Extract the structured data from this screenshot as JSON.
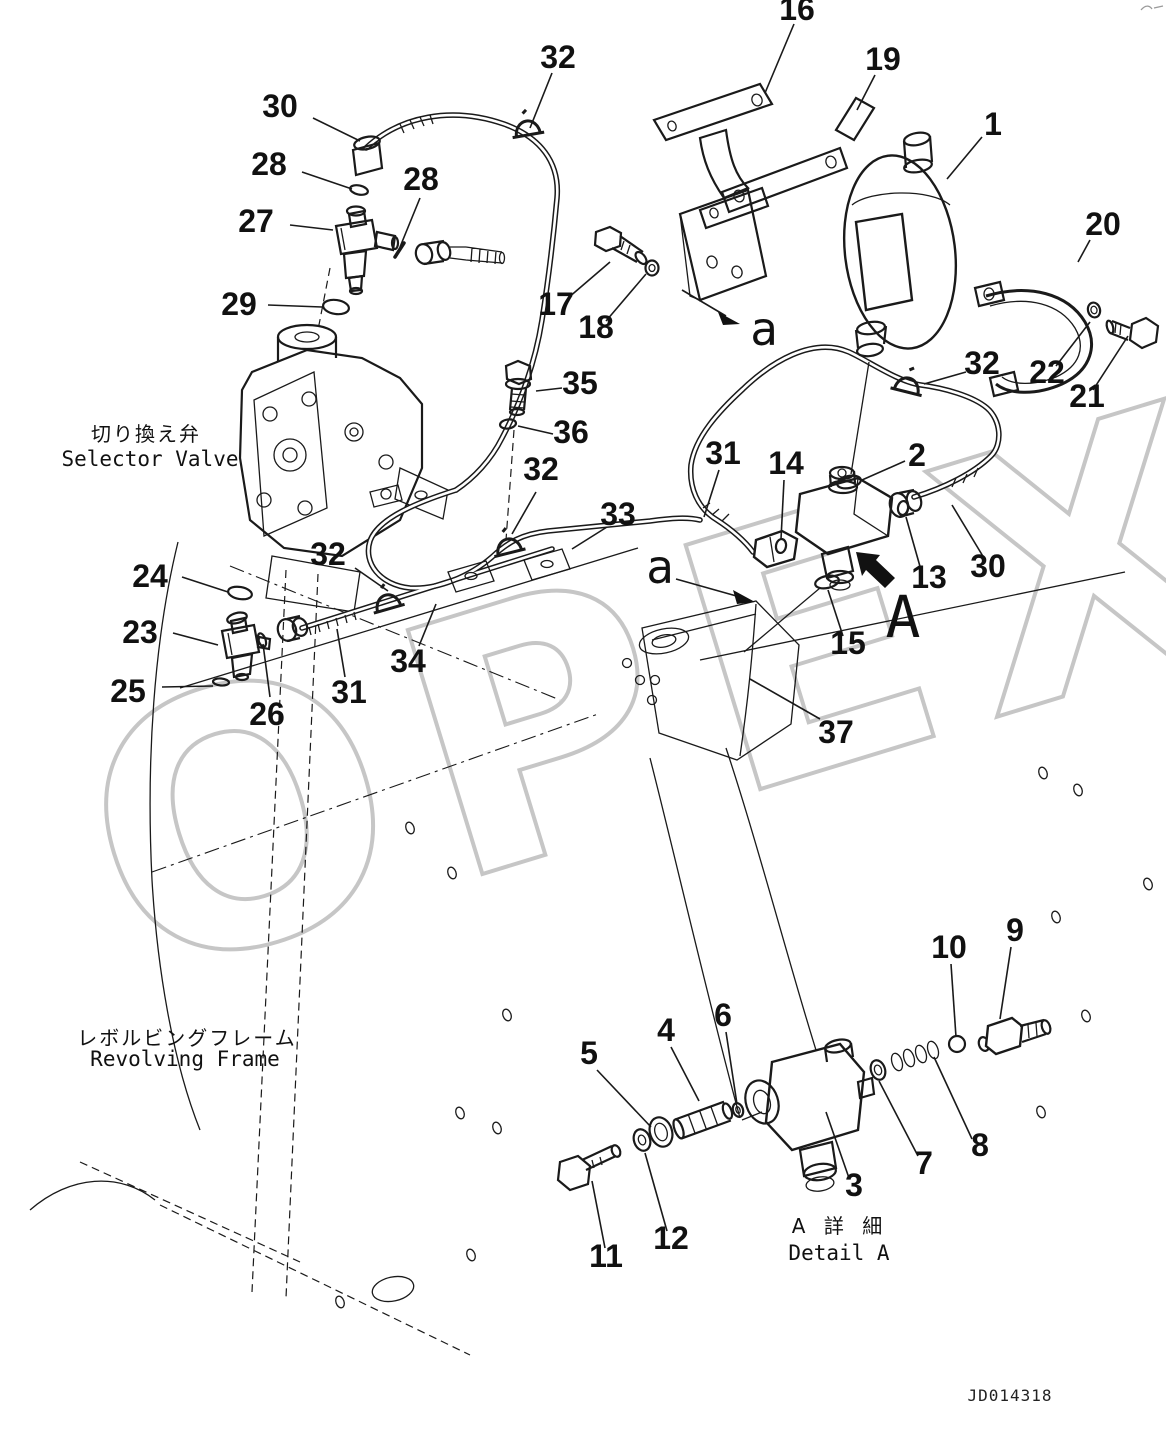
{
  "drawing": {
    "number": "JD014318",
    "watermark": "OPEX"
  },
  "captions": {
    "selector_valve_jp": "切り換え弁",
    "selector_valve_en": "Selector Valve",
    "revolving_frame_jp": "レボルビングフレーム",
    "revolving_frame_en": "Revolving Frame",
    "detail_a_jp": "A 詳 細",
    "detail_a_en": "Detail A"
  },
  "view_labels": {
    "a_top": "a",
    "a_mid": "a",
    "detail": "A"
  },
  "callouts": [
    {
      "label": "1",
      "x": 993,
      "y": 135,
      "leader": [
        982,
        137,
        947,
        179
      ]
    },
    {
      "label": "2",
      "x": 917,
      "y": 466,
      "leader": [
        905,
        461,
        862,
        480
      ]
    },
    {
      "label": "3",
      "x": 854,
      "y": 1196,
      "leader": [
        849,
        1178,
        826,
        1112
      ]
    },
    {
      "label": "4",
      "x": 666,
      "y": 1041,
      "leader": [
        671,
        1047,
        699,
        1101
      ]
    },
    {
      "label": "5",
      "x": 589,
      "y": 1064,
      "leader": [
        597,
        1070,
        651,
        1127
      ]
    },
    {
      "label": "6",
      "x": 723,
      "y": 1026,
      "leader": [
        726,
        1032,
        737,
        1104
      ]
    },
    {
      "label": "7",
      "x": 924,
      "y": 1174,
      "leader": [
        918,
        1156,
        879,
        1081
      ]
    },
    {
      "label": "8",
      "x": 980,
      "y": 1156,
      "leader": [
        972,
        1139,
        934,
        1057
      ]
    },
    {
      "label": "9",
      "x": 1015,
      "y": 941,
      "leader": [
        1011,
        947,
        1000,
        1019
      ]
    },
    {
      "label": "10",
      "x": 949,
      "y": 958,
      "leader": [
        951,
        964,
        956,
        1037
      ]
    },
    {
      "label": "11",
      "x": 606,
      "y": 1267,
      "leader": [
        605,
        1248,
        592,
        1181
      ]
    },
    {
      "label": "12",
      "x": 671,
      "y": 1249,
      "leader": [
        667,
        1231,
        645,
        1153
      ]
    },
    {
      "label": "13",
      "x": 929,
      "y": 588,
      "leader": [
        921,
        570,
        906,
        517
      ]
    },
    {
      "label": "14",
      "x": 786,
      "y": 474,
      "leader": [
        784,
        480,
        781,
        539
      ]
    },
    {
      "label": "15",
      "x": 848,
      "y": 654,
      "leader": [
        843,
        636,
        828,
        590
      ]
    },
    {
      "label": "16",
      "x": 797,
      "y": 20,
      "leader": [
        794,
        24,
        765,
        93
      ]
    },
    {
      "label": "17",
      "x": 556,
      "y": 315,
      "leader": [
        568,
        298,
        610,
        262
      ]
    },
    {
      "label": "18",
      "x": 596,
      "y": 338,
      "leader": [
        606,
        321,
        646,
        274
      ]
    },
    {
      "label": "19",
      "x": 883,
      "y": 70,
      "leader": [
        875,
        75,
        857,
        110
      ]
    },
    {
      "label": "20",
      "x": 1103,
      "y": 235,
      "leader": [
        1090,
        240,
        1078,
        262
      ]
    },
    {
      "label": "21",
      "x": 1087,
      "y": 407,
      "leader": [
        1093,
        390,
        1128,
        336
      ]
    },
    {
      "label": "22",
      "x": 1047,
      "y": 383,
      "leader": [
        1056,
        366,
        1090,
        322
      ]
    },
    {
      "label": "23",
      "x": 140,
      "y": 643,
      "leader": [
        173,
        633,
        218,
        645
      ]
    },
    {
      "label": "24",
      "x": 150,
      "y": 587,
      "leader": [
        182,
        577,
        228,
        592
      ]
    },
    {
      "label": "25",
      "x": 128,
      "y": 702,
      "leader": [
        162,
        687,
        213,
        686
      ]
    },
    {
      "label": "26",
      "x": 267,
      "y": 725,
      "leader": [
        270,
        697,
        263,
        644
      ]
    },
    {
      "label": "27",
      "x": 256,
      "y": 232,
      "leader": [
        290,
        225,
        333,
        230
      ]
    },
    {
      "label": "28",
      "x": 269,
      "y": 175,
      "leader": [
        302,
        172,
        352,
        189
      ]
    },
    {
      "label": "28",
      "x": 421,
      "y": 190,
      "leader": [
        420,
        198,
        400,
        247
      ]
    },
    {
      "label": "29",
      "x": 239,
      "y": 315,
      "leader": [
        268,
        305,
        322,
        307
      ]
    },
    {
      "label": "30",
      "x": 280,
      "y": 117,
      "leader": [
        313,
        118,
        360,
        141
      ]
    },
    {
      "label": "30",
      "x": 988,
      "y": 577,
      "leader": [
        984,
        558,
        952,
        505
      ]
    },
    {
      "label": "31",
      "x": 723,
      "y": 464,
      "leader": [
        719,
        470,
        704,
        517
      ]
    },
    {
      "label": "31",
      "x": 349,
      "y": 703,
      "leader": [
        345,
        677,
        337,
        629
      ]
    },
    {
      "label": "32",
      "x": 558,
      "y": 68,
      "leader": [
        552,
        73,
        530,
        128
      ]
    },
    {
      "label": "32",
      "x": 982,
      "y": 374,
      "leader": [
        966,
        372,
        924,
        384
      ]
    },
    {
      "label": "32",
      "x": 541,
      "y": 480,
      "leader": [
        536,
        492,
        512,
        534
      ]
    },
    {
      "label": "32",
      "x": 328,
      "y": 565,
      "leader": [
        355,
        568,
        388,
        591
      ]
    },
    {
      "label": "33",
      "x": 618,
      "y": 525,
      "leader": [
        607,
        527,
        572,
        549
      ]
    },
    {
      "label": "34",
      "x": 408,
      "y": 672,
      "leader": [
        419,
        646,
        436,
        604
      ]
    },
    {
      "label": "35",
      "x": 580,
      "y": 394,
      "leader": [
        562,
        388,
        536,
        391
      ]
    },
    {
      "label": "36",
      "x": 571,
      "y": 443,
      "leader": [
        553,
        434,
        518,
        426
      ]
    },
    {
      "label": "37",
      "x": 836,
      "y": 743,
      "leader": [
        820,
        719,
        750,
        679
      ]
    }
  ]
}
